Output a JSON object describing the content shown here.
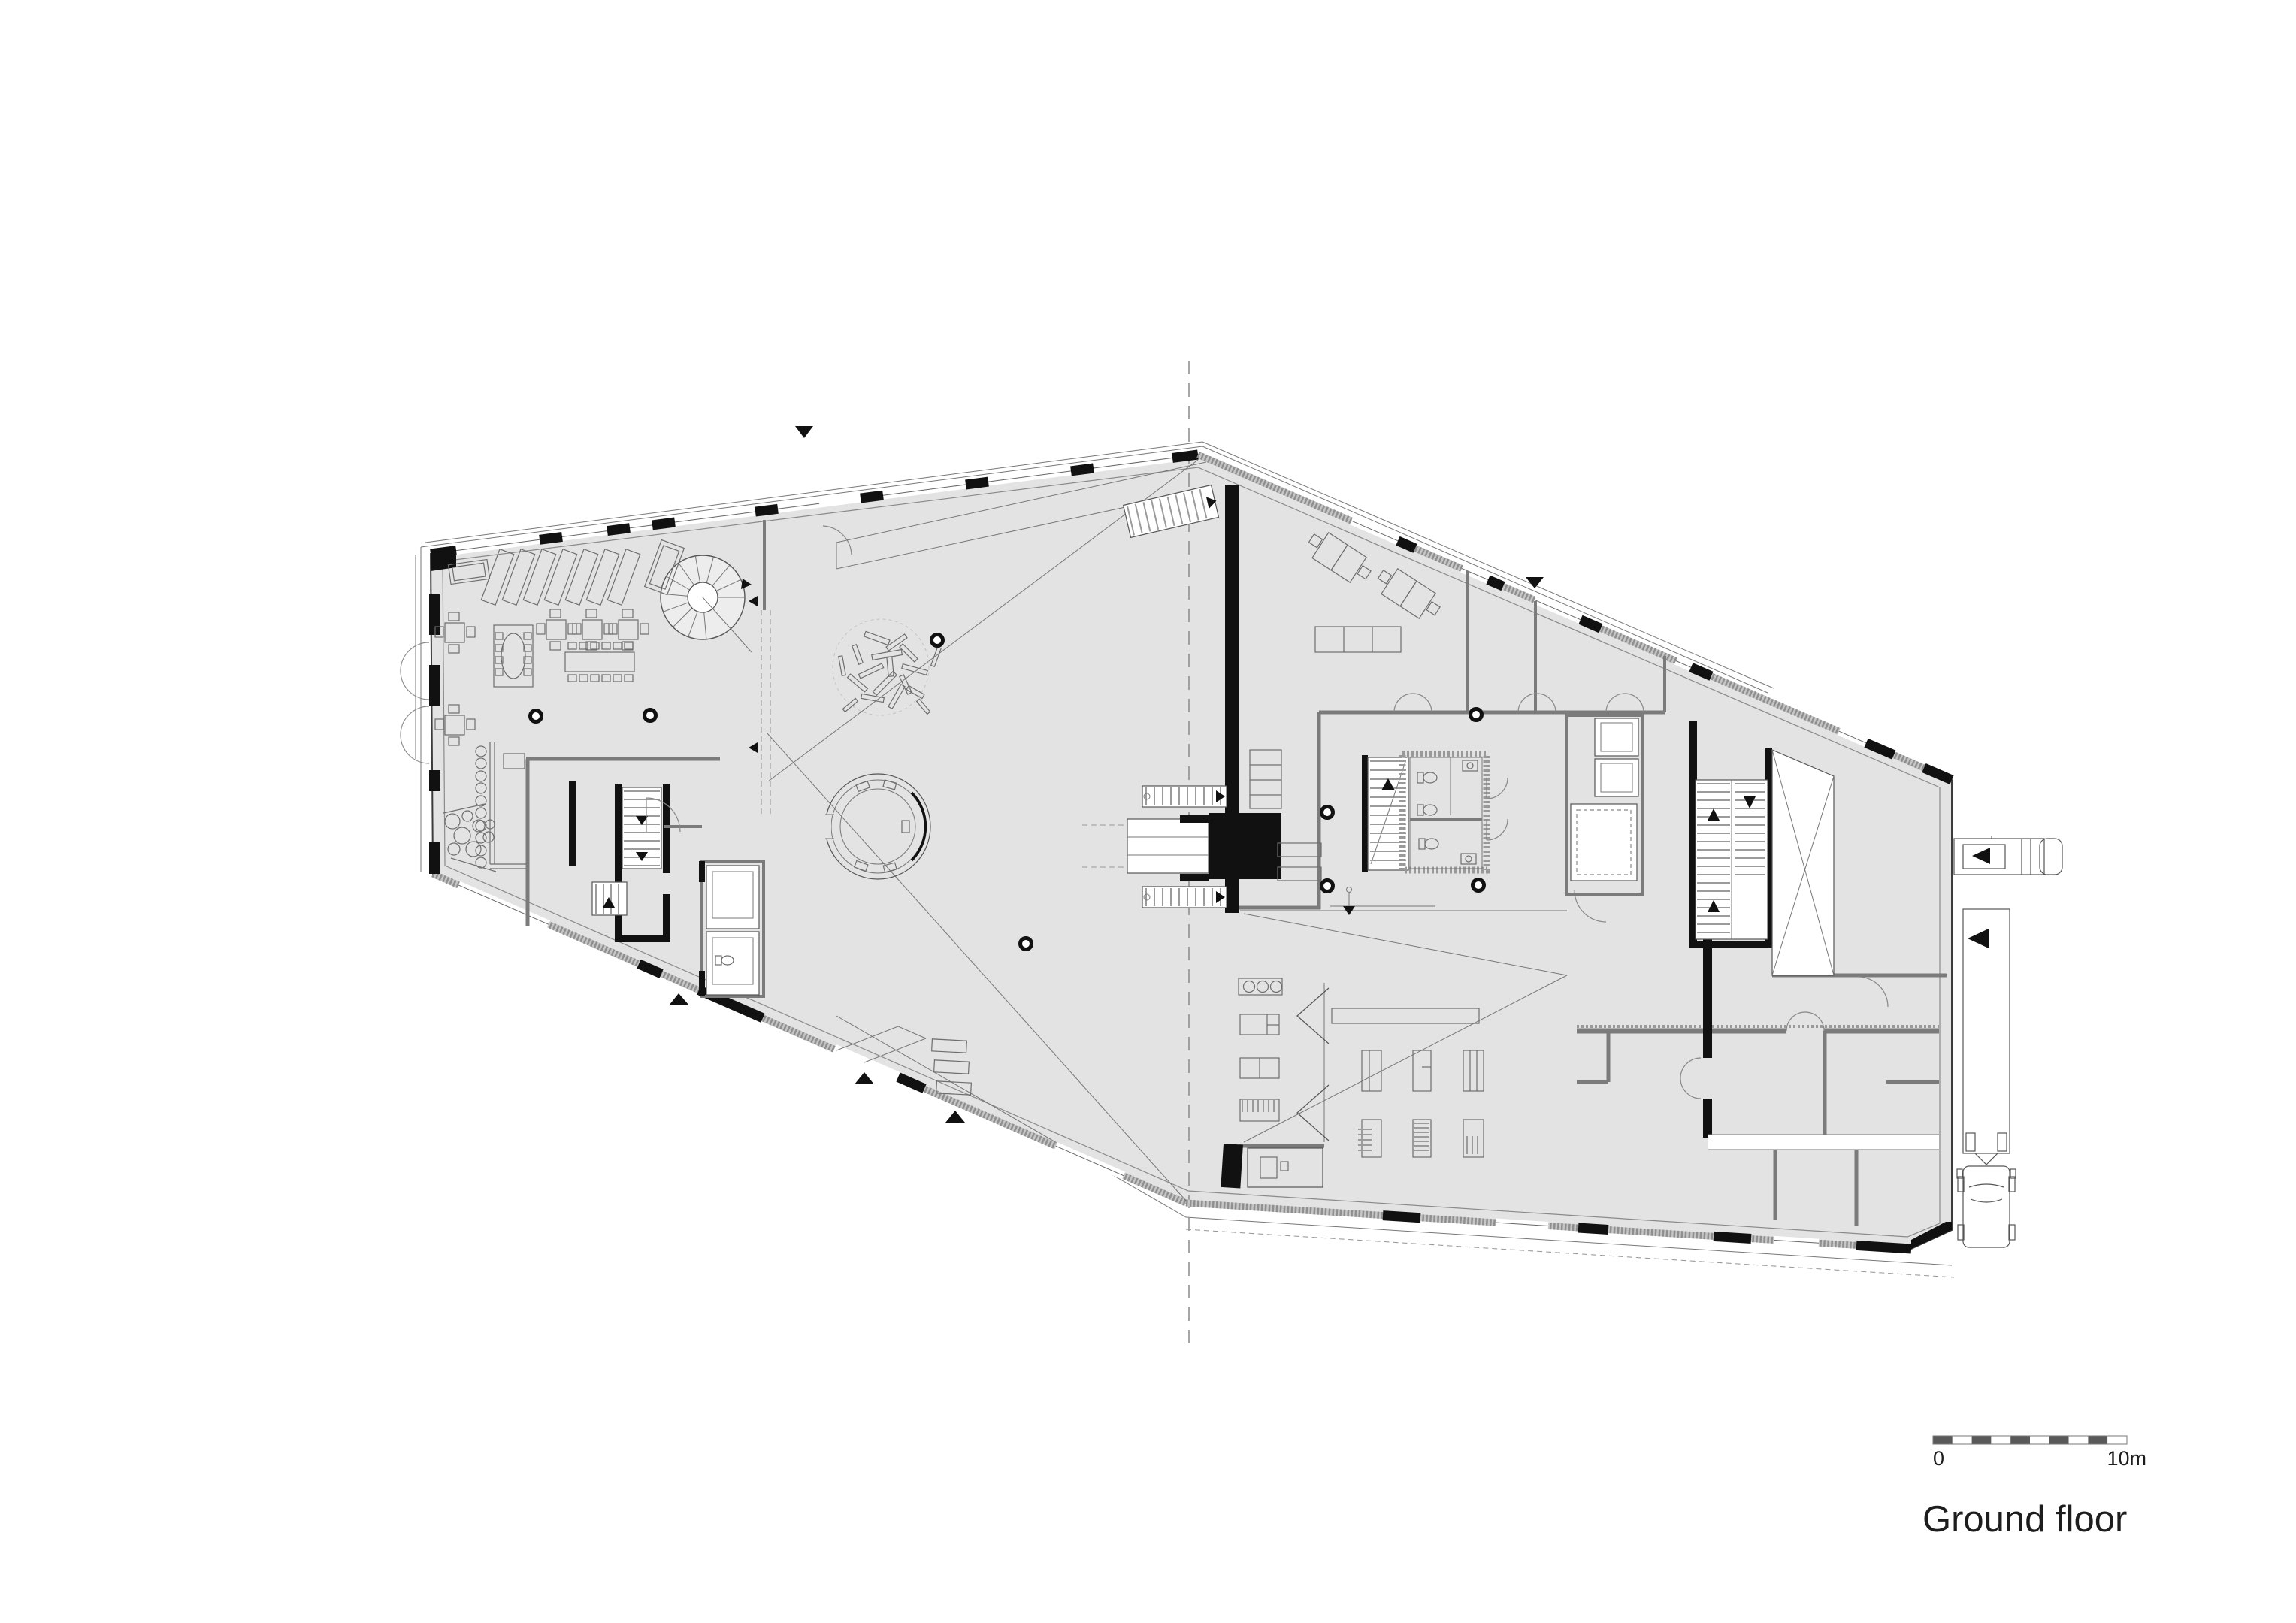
{
  "title": {
    "label": "Ground floor"
  },
  "scale_bar": {
    "zero_label": "0",
    "max_label": "10m",
    "segments": 10,
    "meters_per_segment": 1,
    "total_meters": 10
  },
  "plan": {
    "type": "architectural-floor-plan",
    "floor_name": "Ground floor",
    "orientation": "elongated irregular hexagon, apex at top-center, tip at right with loading dock",
    "features": [
      "restaurant-seating-area",
      "bar-counter-with-stools",
      "lounge-poufs",
      "spiral-staircase",
      "main-hall",
      "scattered-plank-sculpture",
      "round-kiosk-ring",
      "central-black-core-with-entrances",
      "flanking-stairs",
      "toilet-core",
      "office-desks",
      "meeting-rooms",
      "elevator-banks",
      "freight-elevator",
      "stairwells",
      "cross-braced-shaft",
      "workshop-tables",
      "folding-partition",
      "room-grid-bottom-right",
      "corridor",
      "loading-dock",
      "delivery-van",
      "semi-trailer-truck",
      "section-line",
      "entrance-arrows",
      "scale-bar"
    ],
    "column_count": 8,
    "entrance_marker_count": 5
  },
  "colors": {
    "background": "#ffffff",
    "floor": "#e3e3e3",
    "wall": "#7b7b7b",
    "ink": "#111111",
    "hatch": "#8f8f8f",
    "scale_dark": "#595959"
  }
}
